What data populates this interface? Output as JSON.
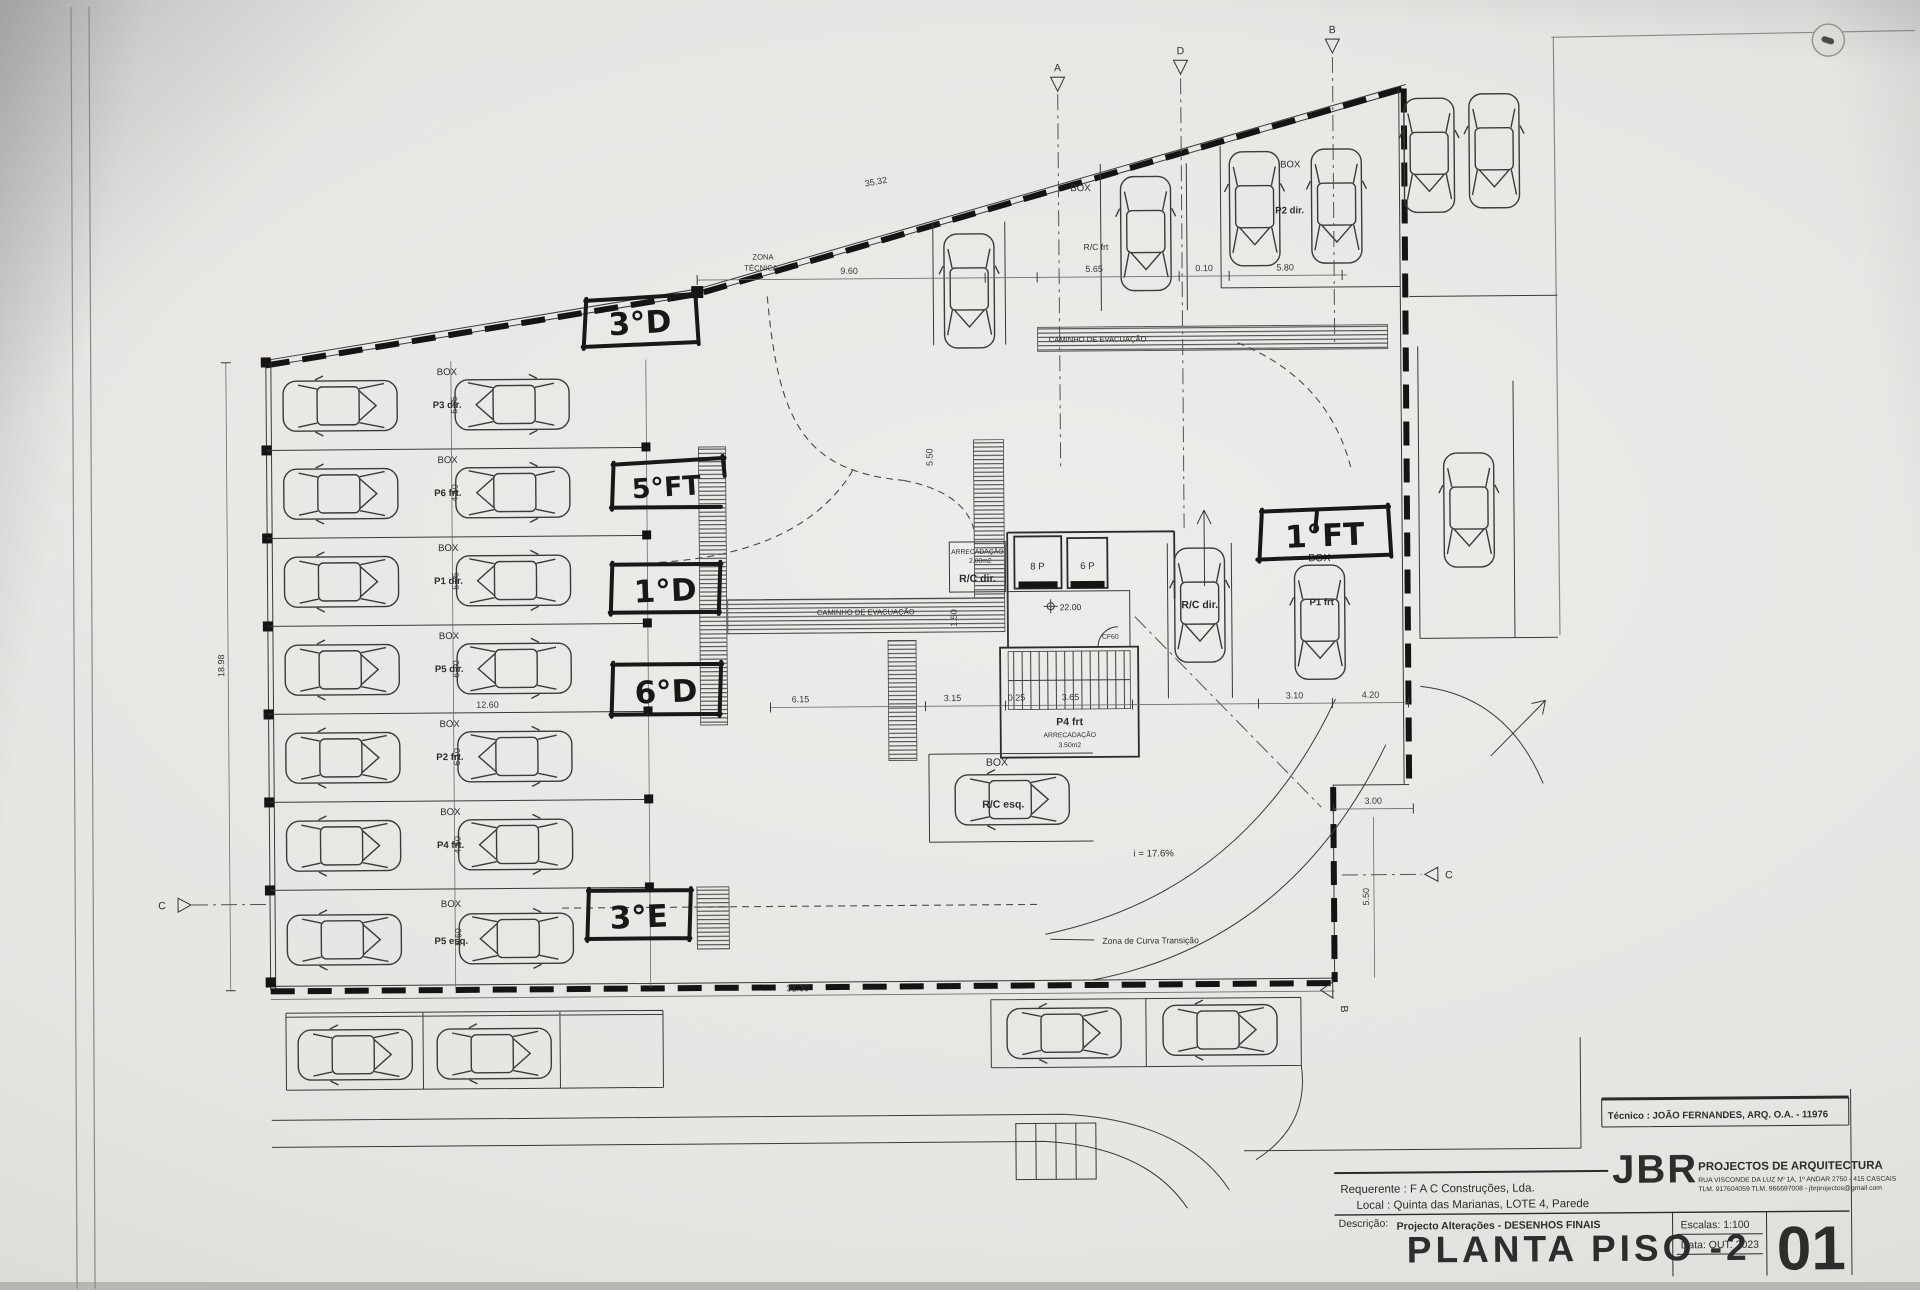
{
  "titleblock": {
    "tecnico": "Técnico : JOÃO FERNANDES, ARQ.   O.A. - 11976",
    "brand": "JBR",
    "brand_sub": "PROJECTOS DE ARQUITECTURA",
    "addr1": "RUA VISCONDE DA LUZ Nº 1A, 1º ANDAR  2750 - 415  CASCAIS",
    "addr2": "TLM. 917604059  TLM. 966697008 - jbrprojectos@gmail.com",
    "requerente": "Requerente : F A C  Construções, Lda.",
    "local": "Local : Quinta das Marianas, LOTE 4, Parede",
    "descricao_label": "Descrição:",
    "descricao": "Projecto Alterações - DESENHOS FINAIS",
    "title": "PLANTA PISO -2",
    "escala": "Escalas:  1:100",
    "data": "Data: OUT.  2023",
    "sheet": "01"
  },
  "handwritten": {
    "u3d": "3°D",
    "u5ft": "5°FT",
    "u1d": "1°D",
    "u6d": "6°D",
    "u3e": "3°E",
    "u1ft": "1°FT"
  },
  "labels": {
    "box": "BOX",
    "zona1": "ZONA",
    "zona2": "TÉCNICA",
    "caminho": "CAMINHO DE EVACUAÇÃO",
    "arrec1": "ARRECADAÇÃO",
    "arrec1b": "2.00m2",
    "rcdir": "R/C dir.",
    "rcesq": "R/C esq.",
    "rcfrt": "R/C frt",
    "p2dir": "P2 dir.",
    "p1frt": "P1 frt",
    "lift8": "8 P",
    "lift6": "6 P",
    "level": "22.00",
    "cf60": "CF60",
    "p4frt": "P4 frt",
    "arrec2": "ARRECADAÇÃO",
    "arrec2b": "3.50m2",
    "slope": "i = 17.6%",
    "curva": "Zona de Curva Transição"
  },
  "stalls": {
    "rows": [
      {
        "box": "BOX",
        "label": "P3 dir.",
        "depth": "5.65"
      },
      {
        "box": "BOX",
        "label": "P6 frt.",
        "depth": "4.50"
      },
      {
        "box": "BOX",
        "label": "P1 dir.",
        "depth": "5.05"
      },
      {
        "box": "BOX",
        "label": "P5 dir.",
        "depth": "6.10"
      },
      {
        "box": "BOX",
        "label": "P2 frt.",
        "depth": "6.10"
      },
      {
        "box": "BOX",
        "label": "P4 frt.",
        "depth": "4.50"
      },
      {
        "box": "BOX",
        "label": "P5 esq.",
        "depth": "5.60"
      }
    ]
  },
  "dims": {
    "top": "35.32",
    "zona": "9.60",
    "t565": "5.65",
    "t010": "0.10",
    "t580": "5.80",
    "w1260": "12.60",
    "c615": "6.15",
    "c315": "3.15",
    "c025": "0.25",
    "c365": "3.65",
    "c310": "3.10",
    "c420": "4.20",
    "r300": "3.00",
    "r550": "5.50",
    "m550": "5.50",
    "m150": "1.50",
    "b3130": "31.30",
    "l1898": "18.98"
  },
  "sections": {
    "a": "A",
    "b": "B",
    "c": "C",
    "d": "D"
  }
}
